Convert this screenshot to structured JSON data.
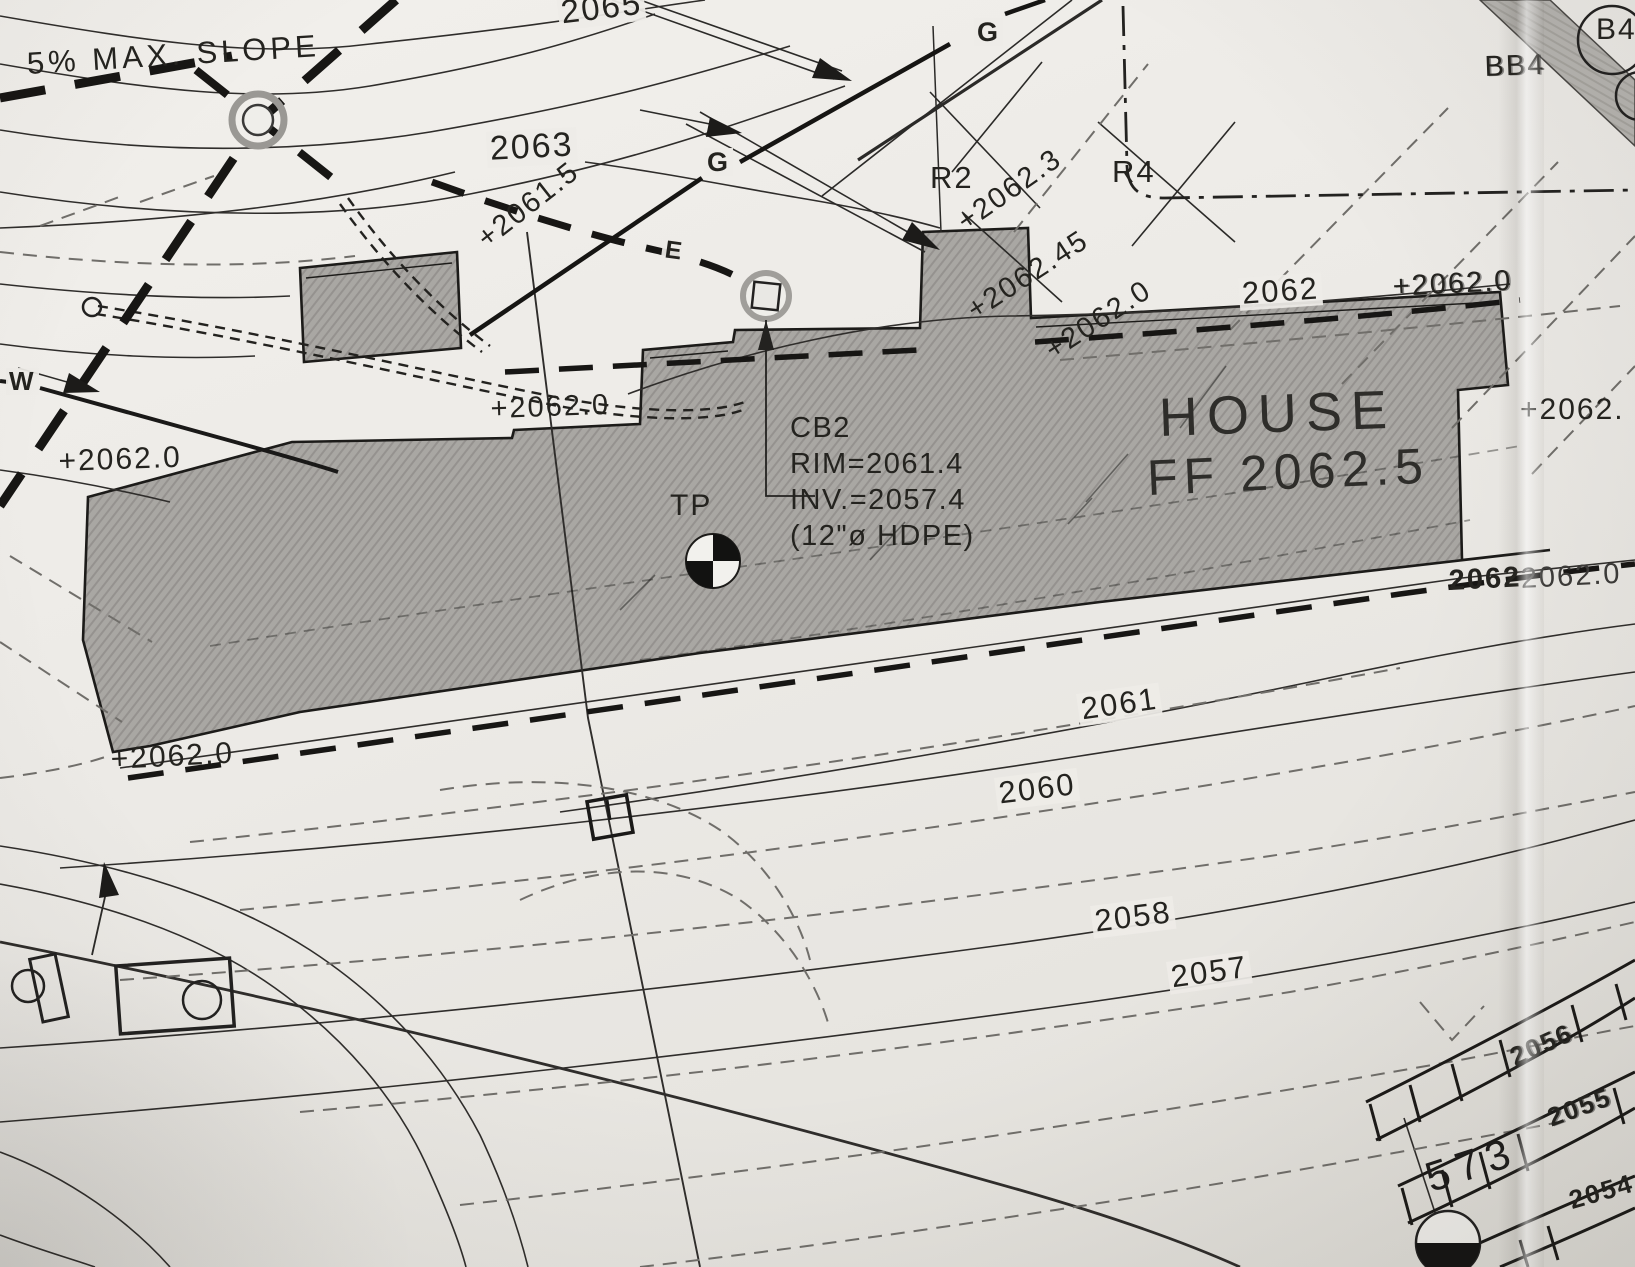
{
  "colors": {
    "paper": "#eceae6",
    "ink": "#24231f",
    "house_fill": "#a9a7a3",
    "driveway_fill": "#b8b6b2",
    "dashed_gray": "#6f6d69"
  },
  "labels": {
    "max_slope": "5% MAX. SLOPE",
    "house": "HOUSE",
    "house_ff": "FF 2062.5",
    "tp": "TP",
    "w": "W",
    "g1": "G",
    "g2": "G",
    "e1": "E",
    "r2": "R2",
    "r4": "R4",
    "bb4": "BB4",
    "b4": "B4",
    "n573": "573"
  },
  "cb2": {
    "line1": "CB2",
    "line2": "RIM=2061.4",
    "line3": "INV.=2057.4",
    "line4": "(12\"ø HDPE)"
  },
  "contours": {
    "c2065": "2065",
    "c2063": "2063",
    "c2062": "2062",
    "c2062b": "2062",
    "c2061": "2061",
    "c2060": "2060",
    "c2058": "2058",
    "c2057": "2057"
  },
  "spots": {
    "s2061_5": "+2061.5",
    "s2062_3": "+2062.3",
    "s2062_45": "+2062.45",
    "s2062_0_a": "+2062.0",
    "s2062_0_tr": "+2062.0",
    "s2062_0_left": "+2062.0",
    "s2062_0_mid": "+2062.0",
    "s2062_0_bl": "+2062.0",
    "s2062_right": "+2062.",
    "s2062_0_r": "2062.0"
  },
  "walls": {
    "w2056": "2056",
    "w2055": "2055",
    "w2054": "2054"
  }
}
